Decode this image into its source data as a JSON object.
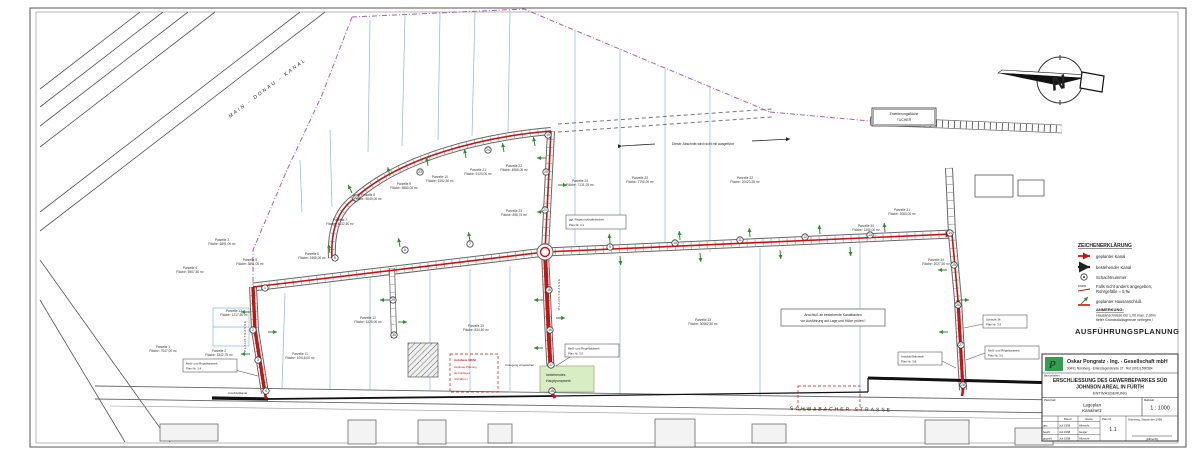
{
  "sheet": {
    "stage": "AUSFÜHRUNGSPLANUNG",
    "north": "N"
  },
  "legend": {
    "title": "ZEICHENERKLÄRUNG",
    "items": [
      {
        "icon": "planned-canal-line",
        "label": "geplanter Kanal"
      },
      {
        "icon": "existing-canal-line",
        "label": "bestehender Kanal"
      },
      {
        "icon": "shaft-circle",
        "label": "Schachtnummer"
      },
      {
        "icon": "pipe-slope-symbol",
        "label1": "Falls nicht anders angegeben,",
        "label2": "Rohrgefälle = 5 ‰"
      },
      {
        "icon": "house-connection-arrow",
        "label": "geplanter Hausanschluß"
      }
    ],
    "note_title": "ANMERKUNG:",
    "note1": "Hausanschlüsse bis 1,00 max. 2,00m",
    "note2": "tiefer Grundstücksgrenze verlegen !",
    "colors": {
      "planned": "#cc1111",
      "existing": "#111111",
      "connection": "#2e8b2e"
    }
  },
  "title_block": {
    "logo_letter": "P",
    "company": "Oskar Pongratz - Ing. - Gesellschaft mbH",
    "address": "90491 Nürnberg · Erlenstegenstraße 37 · Ruf (0911) 590584",
    "project_label": "Bauvorhaben:",
    "project1": "ERSCHLIESSUNG DES GEWERBEPARKES SÜD",
    "project2": "JOHNSON AREAL IN FÜRTH",
    "section": "ENTWÄSSERUNG",
    "content_label": "Planinhalt:",
    "content1": "Lageplan",
    "content2": "Kanalnetz",
    "scale_label": "Maßstab:",
    "scale": "1 : 1000",
    "col_date": "Datum",
    "col_name": "Name",
    "rows": [
      {
        "who": "gez.",
        "date": "Juli 1998",
        "name": "Albrecht"
      },
      {
        "who": "bearb.",
        "date": "Juli 1998",
        "name": "Geiger"
      },
      {
        "who": "geprüft",
        "date": "Juli 1998",
        "name": "Albrecht"
      }
    ],
    "plan_no_label": "Plan Nr.",
    "plan_no": "1.1",
    "date_note": "Nürnberg, September 1998",
    "signature": "(Albrecht)"
  },
  "labels": {
    "main_canal": "MAIN - DONAU - KANAL",
    "schwabacher": "SCHWABACHER STRASSE",
    "planstrasse": "PLANSTRASSE",
    "erweiterung1": "Erweiterungsfläche",
    "erweiterung2": "TUCHER",
    "not_executed": "Dieser Abschnitt wird nicht mit ausgeführt",
    "check1": "Anschluß an bestehende Kanalbauten",
    "check2": "vor Ausführung auf Lage und Höhe prüfen !",
    "rrb1": "ggf. Regenrückhaltebecken",
    "rrb2": "Plan Nr. 3.1",
    "mess34_1": "Meß- und Regelbauwerk",
    "mess34_2": "Plan Nr. 3.4",
    "mess35_1": "Meß- und Regelbauwerk",
    "mess35_2": "Plan Nr. 3.5",
    "mess36_1": "Meß- und Regelbauwerk",
    "mess36_2": "Plan Nr. 3.6",
    "anschluss38_1": "Anschlußbauwerk",
    "anschluss38_2": "Plan Nr. 3.8",
    "schacht39_1": "Schacht 36",
    "schacht39_2": "Plan Nr. 3.9",
    "autohaus1": "Autohaus GRAF",
    "autohaus2": "separate Planung",
    "autohaus3": "als künftiges",
    "autohaus4": "Vorhaben !",
    "pumpwerk1": "bestehendes",
    "pumpwerk2": "Hauptpumpwerk",
    "umlegung": "Umlegung vorgesehen",
    "anschlusskanal": "Anschlußkanal"
  },
  "plan": {
    "parcels": [
      {
        "x": 163,
        "y": 348,
        "n": "Parzelle 1",
        "a": "Fläche: 7047,00 m²"
      },
      {
        "x": 219,
        "y": 352,
        "n": "Parzelle 2",
        "a": "Fläche: 3342,75 m²"
      },
      {
        "x": 222,
        "y": 241,
        "n": "Parzelle 3",
        "a": "Fläche: 6891,00 m²"
      },
      {
        "x": 190,
        "y": 269,
        "n": "Parzelle 4",
        "a": "Fläche: 5907,50 m²"
      },
      {
        "x": 250,
        "y": 261,
        "n": "Parzelle 5",
        "a": "Fläche: 3891,00 m²"
      },
      {
        "x": 312,
        "y": 255,
        "n": "Parzelle 6",
        "a": "Fläche: 2465,00 m²"
      },
      {
        "x": 340,
        "y": 221,
        "n": "Parzelle 7",
        "a": "Fläche: 4132,50 m²"
      },
      {
        "x": 368,
        "y": 196,
        "n": "Parzelle 8",
        "a": "Fläche: 5049,00 m²"
      },
      {
        "x": 404,
        "y": 185,
        "n": "Parzelle 9",
        "a": "Fläche: 5880,00 m²"
      },
      {
        "x": 440,
        "y": 178,
        "n": "Parzelle 10",
        "a": "Fläche: 6162,50 m²"
      },
      {
        "x": 478,
        "y": 171,
        "n": "Parzelle 21",
        "a": "Fläche: 5125,00 m²"
      },
      {
        "x": 514,
        "y": 167,
        "n": "Parzelle 22",
        "a": "Fläche: 4966,00 m²"
      },
      {
        "x": 514,
        "y": 212,
        "n": "Parzelle 23",
        "a": "Fläche: 898,75 m²"
      },
      {
        "x": 580,
        "y": 182,
        "n": "Parzelle 24",
        "a": "Fläche: 7131,25 m²"
      },
      {
        "x": 640,
        "y": 179,
        "n": "Parzelle 25",
        "a": "Fläche: 7790,00 m²"
      },
      {
        "x": 745,
        "y": 179,
        "n": "Parzelle 32",
        "a": "Fläche: 20023,25 m²"
      },
      {
        "x": 234,
        "y": 312,
        "n": "Parzelle 13",
        "a": "Fläche: 1217,50 m²"
      },
      {
        "x": 300,
        "y": 355,
        "n": "Parzelle 11",
        "a": "Fläche: 10018,00 m²"
      },
      {
        "x": 368,
        "y": 319,
        "n": "Parzelle 12",
        "a": "Fläche: 6125,00 m²"
      },
      {
        "x": 476,
        "y": 327,
        "n": "Parzelle 29",
        "a": "Fläche: 834,50 m²"
      },
      {
        "x": 703,
        "y": 321,
        "n": "Parzelle 33",
        "a": "Fläche: 30562,50 m²"
      },
      {
        "x": 866,
        "y": 227,
        "n": "Parzelle 30",
        "a": "Fläche: 1260,00 m²"
      },
      {
        "x": 902,
        "y": 211,
        "n": "Parzelle 31",
        "a": "Fläche: 3060,00 m²"
      },
      {
        "x": 936,
        "y": 261,
        "n": "Parzelle 34",
        "a": "Fläche: 2027,50 m²"
      }
    ],
    "shafts": [
      {
        "x": 265,
        "y": 288,
        "n": "1"
      },
      {
        "x": 253,
        "y": 330,
        "n": "2"
      },
      {
        "x": 258,
        "y": 360,
        "n": "3"
      },
      {
        "x": 266,
        "y": 391,
        "n": "4"
      },
      {
        "x": 335,
        "y": 258,
        "n": "5"
      },
      {
        "x": 405,
        "y": 250,
        "n": "6"
      },
      {
        "x": 470,
        "y": 244,
        "n": "7"
      },
      {
        "x": 610,
        "y": 247,
        "n": "9"
      },
      {
        "x": 675,
        "y": 243,
        "n": "10"
      },
      {
        "x": 740,
        "y": 240,
        "n": "11"
      },
      {
        "x": 805,
        "y": 237,
        "n": "12"
      },
      {
        "x": 870,
        "y": 235,
        "n": "13"
      },
      {
        "x": 950,
        "y": 233,
        "n": "14"
      },
      {
        "x": 549,
        "y": 290,
        "n": "15"
      },
      {
        "x": 550,
        "y": 330,
        "n": "16"
      },
      {
        "x": 551,
        "y": 365,
        "n": "17"
      },
      {
        "x": 552,
        "y": 391,
        "n": "18"
      },
      {
        "x": 548,
        "y": 135,
        "n": "19"
      },
      {
        "x": 546,
        "y": 172,
        "n": "20"
      },
      {
        "x": 545,
        "y": 210,
        "n": "21"
      },
      {
        "x": 356,
        "y": 198,
        "n": "22"
      },
      {
        "x": 420,
        "y": 172,
        "n": "23"
      },
      {
        "x": 488,
        "y": 150,
        "n": "24"
      },
      {
        "x": 954,
        "y": 265,
        "n": "25"
      },
      {
        "x": 958,
        "y": 305,
        "n": "26"
      },
      {
        "x": 961,
        "y": 345,
        "n": "27"
      },
      {
        "x": 963,
        "y": 385,
        "n": "28"
      },
      {
        "x": 393,
        "y": 300,
        "n": "29"
      },
      {
        "x": 394,
        "y": 335,
        "n": "30"
      }
    ],
    "connections": [
      [
        352,
        193,
        -115
      ],
      [
        390,
        176,
        -105
      ],
      [
        428,
        166,
        -100
      ],
      [
        466,
        158,
        -100
      ],
      [
        504,
        152,
        -100
      ],
      [
        535,
        146,
        -100
      ],
      [
        330,
        253,
        -100
      ],
      [
        400,
        247,
        -100
      ],
      [
        470,
        241,
        -100
      ],
      [
        610,
        243,
        -95
      ],
      [
        680,
        240,
        -95
      ],
      [
        750,
        237,
        -95
      ],
      [
        820,
        234,
        -95
      ],
      [
        885,
        232,
        -95
      ],
      [
        620,
        256,
        85
      ],
      [
        700,
        253,
        85
      ],
      [
        780,
        250,
        85
      ],
      [
        850,
        247,
        85
      ],
      [
        543,
        300,
        180
      ],
      [
        556,
        318,
        0
      ],
      [
        543,
        348,
        180
      ],
      [
        250,
        312,
        180
      ],
      [
        268,
        332,
        0
      ],
      [
        250,
        354,
        180
      ],
      [
        546,
        158,
        180
      ],
      [
        558,
        185,
        0
      ],
      [
        546,
        212,
        180
      ],
      [
        947,
        270,
        180
      ],
      [
        960,
        300,
        0
      ],
      [
        948,
        332,
        180
      ],
      [
        389,
        300,
        180
      ],
      [
        398,
        322,
        0
      ]
    ]
  }
}
